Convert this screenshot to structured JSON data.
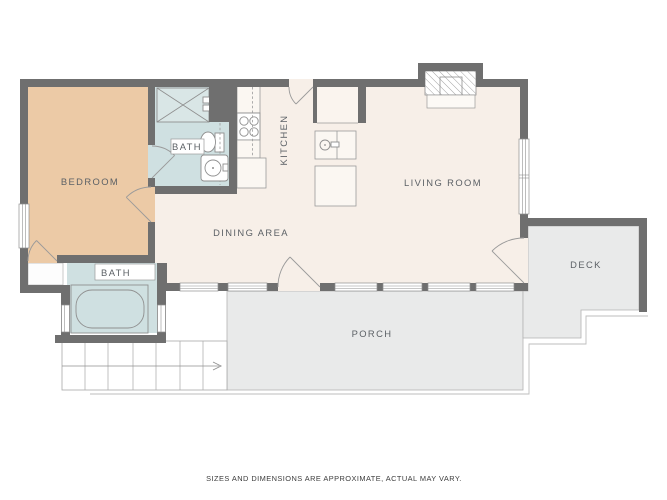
{
  "labels": {
    "bedroom": "BEDROOM",
    "bath_upper": "BATH",
    "kitchen": "KITCHEN",
    "dining": "DINING AREA",
    "living": "LIVING ROOM",
    "deck": "DECK",
    "porch": "PORCH",
    "bath_lower": "BATH"
  },
  "disclaimer": "SIZES AND DIMENSIONS ARE APPROXIMATE, ACTUAL MAY VARY.",
  "colors": {
    "wall": "#6f6f6f",
    "floor": "#f7efe8",
    "bedroom_floor": "#eccaa6",
    "bath_floor": "#cfe0e1",
    "outdoor_floor": "#e9eaea",
    "line": "#8f8f8f",
    "label_text": "#5c6166"
  }
}
